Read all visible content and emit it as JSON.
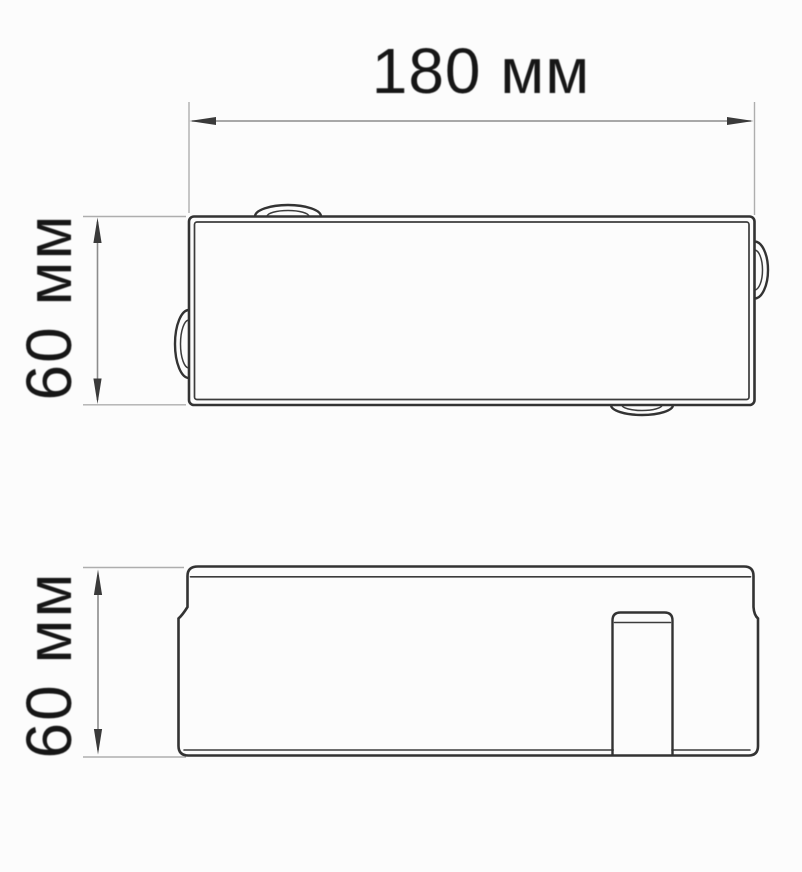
{
  "drawing": {
    "title": "Box dimension drawing, two orthographic views",
    "views": [
      {
        "id": "top-view",
        "description": "Plan view: rectangle with double-wall outline and four oval knock-out tabs on the edges"
      },
      {
        "id": "side-view",
        "description": "Side elevation: lid with seam line, stepped sides, internal cable-entry tab at right"
      }
    ],
    "dimensions": [
      {
        "id": "width",
        "label": "180 мм",
        "value": 180,
        "unit": "мм",
        "orientation": "horizontal",
        "view": "top-view"
      },
      {
        "id": "height-top-view",
        "label": "60 мм",
        "value": 60,
        "unit": "мм",
        "orientation": "vertical",
        "view": "top-view"
      },
      {
        "id": "height-side-view",
        "label": "60 мм",
        "value": 60,
        "unit": "мм",
        "orientation": "vertical",
        "view": "side-view"
      }
    ],
    "colors": {
      "background": "#fcfcfc",
      "outline": "#333333",
      "inner_line": "#3c3c3c",
      "dimension_line": "#8c8c8c",
      "extension_line": "#aeaeae",
      "arrow": "#3a3a3a",
      "label_text": "#161616"
    }
  }
}
